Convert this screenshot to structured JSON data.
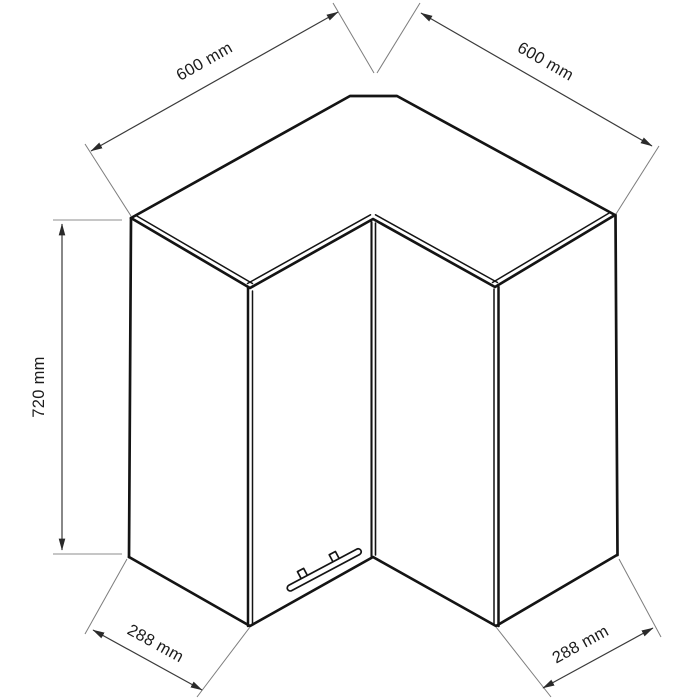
{
  "dimensions": {
    "top_left": {
      "label": "600 mm"
    },
    "top_right": {
      "label": "600 mm"
    },
    "height": {
      "label": "720 mm"
    },
    "bottom_left": {
      "label": "288 mm"
    },
    "bottom_right": {
      "label": "288 mm"
    }
  },
  "colors": {
    "cabinet_line": "#141414",
    "dimension_line": "#3a3a3a",
    "extension_line": "#7d7d7d",
    "background": "#ffffff"
  }
}
